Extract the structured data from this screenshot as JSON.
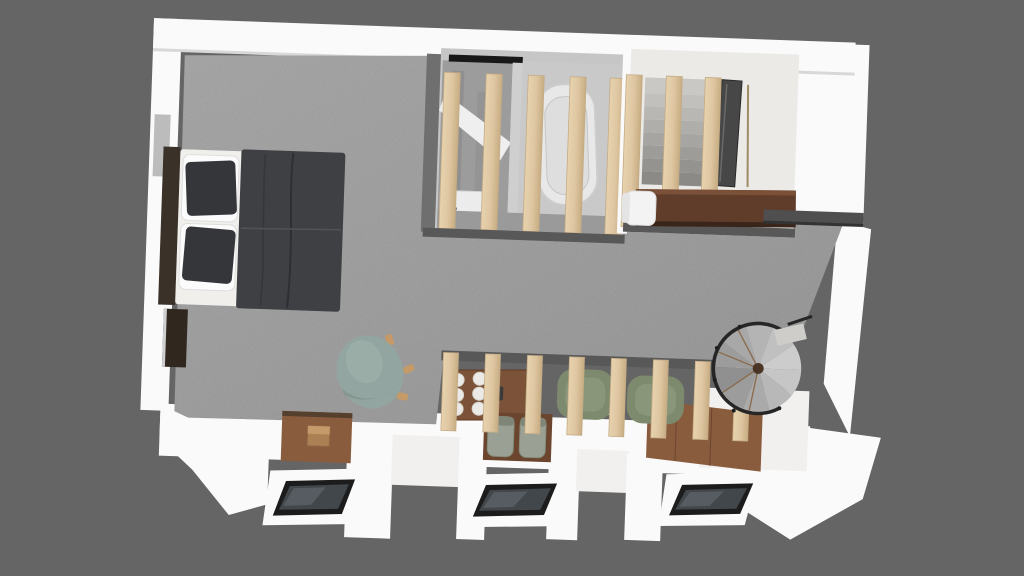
{
  "scene": {
    "title": "Top-down 3D render of a studio apartment floor plan",
    "background": "#656565"
  },
  "colors": {
    "background": "#656565",
    "wall": "#fafafa",
    "room_wall_edge": "#585858",
    "carpet": "#8a8a8a",
    "wood_slat": "#e0c9a4",
    "wood_slat_edge": "#c3ab85",
    "wood_floor": "#8a5c3e",
    "wood_floor_dark": "#6b452e",
    "headboard": "#3a3129",
    "mattress": "#f0efec",
    "duvet": "#3e4044",
    "pillow_dark": "#34363a",
    "pillow_white": "#fbfbfb",
    "wardrobe": "#30281f",
    "bath_wall": "#c6c6c6",
    "bath_floor": "#9c9c9c",
    "tub": "#e8e8e8",
    "shower_tray": "#ececec",
    "stair_concrete": "#b3b1ae",
    "mirror": "#474747",
    "desk": "#5f3d2a",
    "ledge": "#4f4f4f",
    "table": "#7c5338",
    "plate": "#eceae6",
    "chair_gray": "#9aa094",
    "armchair_sage": "#7e8a6e",
    "lounge_teal": "#93a5a0",
    "side_table": "#f2f2f0",
    "window_frame": "#1c1c1c",
    "window_glass": "#42474b",
    "spiral_step": "#b7b7b7",
    "spiral_rail": "#262626",
    "stool_wood": "#b5895c"
  },
  "objects": [
    "double-bed",
    "wardrobe-niche",
    "teal-lounge-chair",
    "bathroom-block",
    "shower",
    "bathtub",
    "wood-slat-partition",
    "staircase-block",
    "concrete-stairs",
    "mirror-panel",
    "desk-counter",
    "desk-chair",
    "wall-ledge",
    "dining-table",
    "dining-plates",
    "dining-chairs",
    "sage-armchairs",
    "side-table",
    "spiral-staircase",
    "wood-floor-alcoves",
    "wooden-stool",
    "roof-windows",
    "carpet-area"
  ]
}
